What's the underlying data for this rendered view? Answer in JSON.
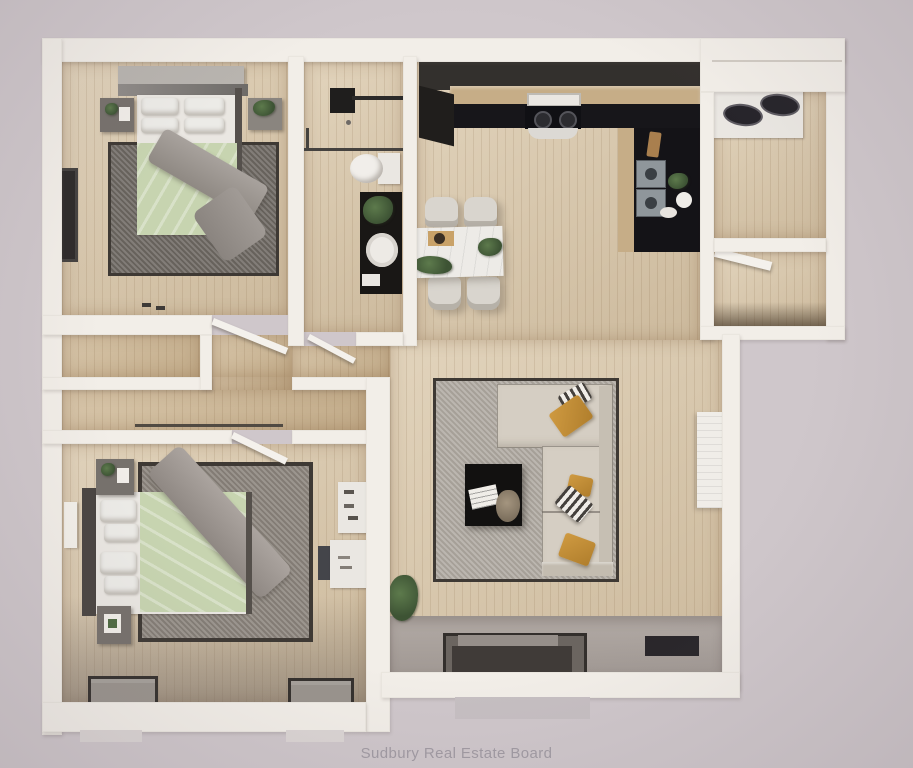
{
  "caption": {
    "text": "Sudbury Real Estate Board"
  },
  "floorplan": {
    "kind": "3d-rendered-top-down-floor-plan",
    "rooms": [
      "bedroom-1",
      "bathroom",
      "kitchen",
      "dining-area",
      "laundry-room",
      "storage-closet",
      "hallway-closets",
      "living-room",
      "bedroom-2",
      "entry"
    ],
    "furniture": [
      "double-bed-1",
      "double-bed-2",
      "nightstands",
      "tv-console",
      "shower",
      "toilet",
      "vanity-sink",
      "range-hood-stove",
      "double-sink",
      "washer-dryer",
      "dining-table",
      "four-chairs",
      "sectional-sofa",
      "coffee-table",
      "area-rugs",
      "desk",
      "shelving",
      "radiator",
      "door-mats",
      "plants"
    ]
  },
  "palette": {
    "bg": "#cfc7cb",
    "wall": "#f2eee8",
    "wood": "#d8c7ab",
    "wood_dark": "#cbb593",
    "charcoal": "#33302d",
    "counter": "#17161a",
    "steel": "#8f969b",
    "rug_border": "#3e3934",
    "rug1": "#6d6862",
    "rug2": "#b0aaa2",
    "rug3": "#8b847c",
    "duvet": "#c7d4b0",
    "sofa": "#d5cec3",
    "mustard": "#cf9a41",
    "entry": "#a19994",
    "marble": "#edebe7",
    "plant": "#3d5334",
    "caption": "#a19ba3"
  }
}
